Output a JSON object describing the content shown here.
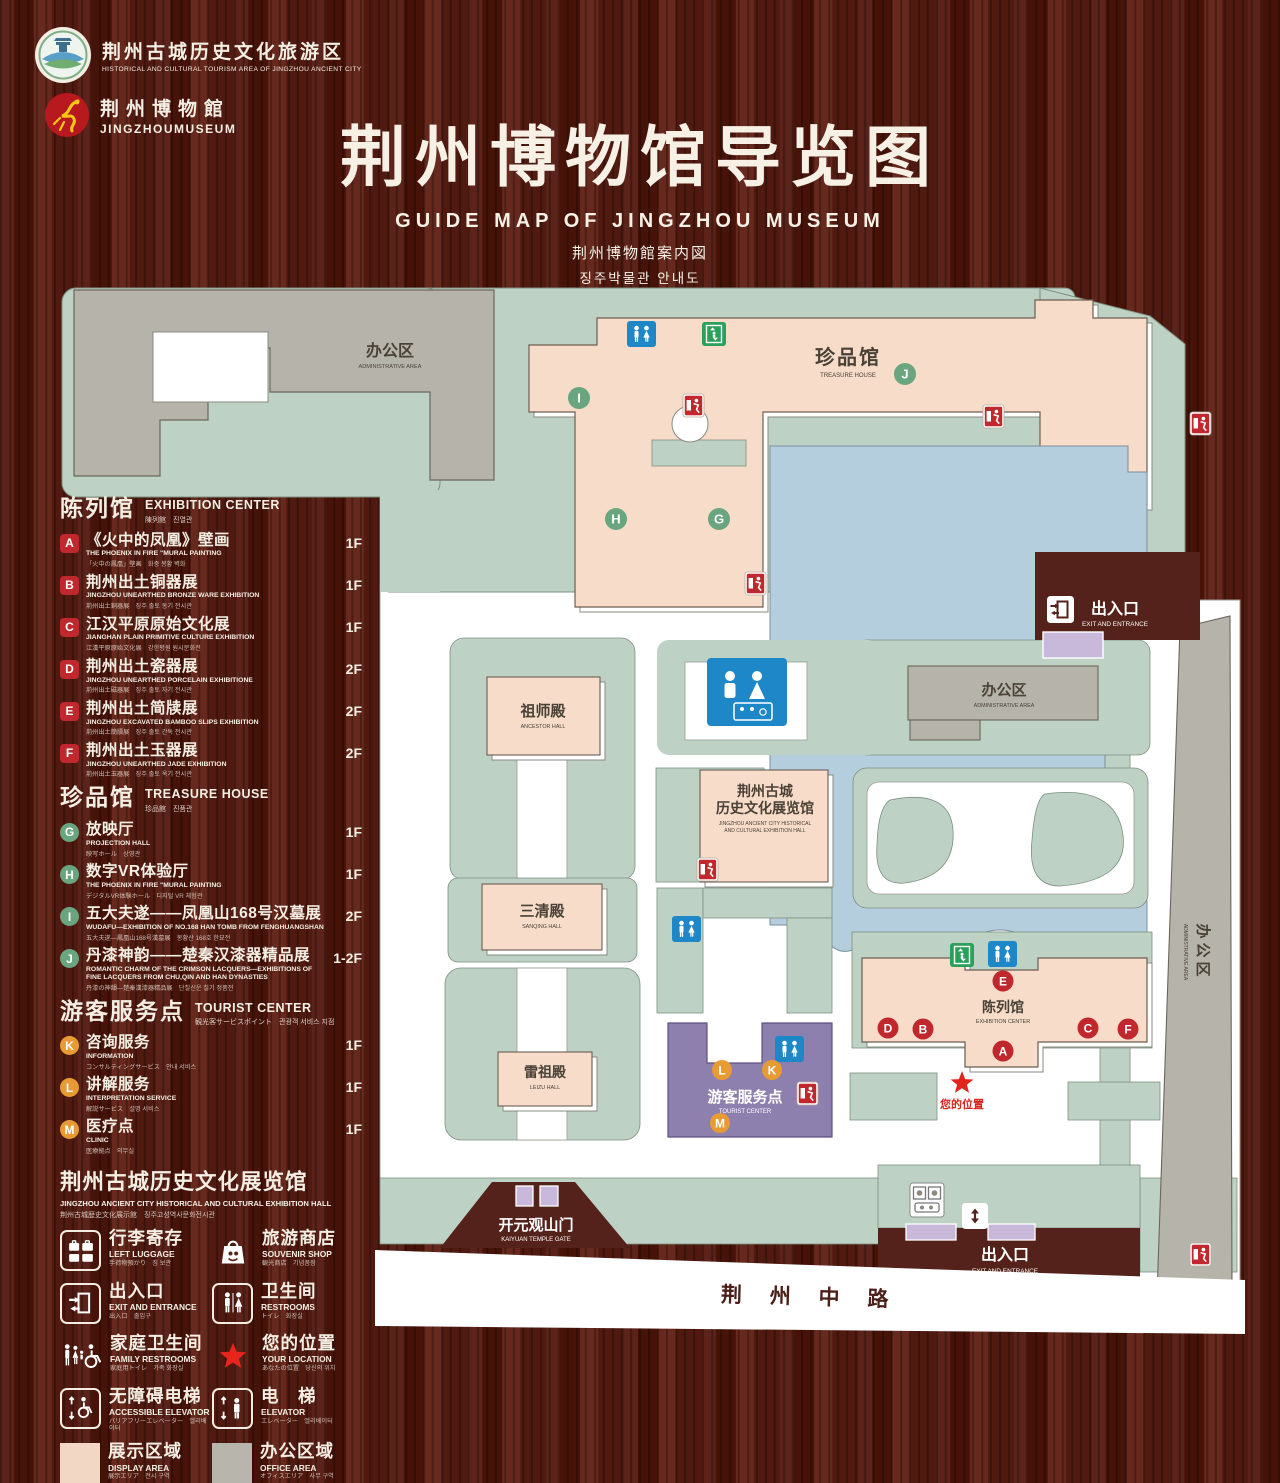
{
  "header": {
    "logo1": {
      "zh": "荆州古城历史文化旅游区",
      "en": "HISTORICAL AND CULTURAL TOURISM AREA OF JINGZHOU ANCIENT CITY"
    },
    "logo2": {
      "zh": "荆州博物館",
      "en": "JINGZHOUMUSEUM"
    },
    "title_zh": "荆州博物馆导览图",
    "title_en": "GUIDE MAP OF JINGZHOU MUSEUM",
    "title_jp": "荆州博物館案内図",
    "title_kr": "징주박물관 안내도"
  },
  "legend": {
    "sections": [
      {
        "id": "exhibition",
        "title_zh": "陈列馆",
        "title_en": "EXHIBITION CENTER",
        "title_sub": "陳列館　진열관",
        "badge_shape": "square",
        "badge_color": "#c0282d",
        "items": [
          {
            "letter": "A",
            "zh": "《火中的凤凰》壁画",
            "en": "THE PHOENIX IN FIRE \"MURAL PAINTING",
            "sub": "「火中の鳳凰」壁画　화중 봉황 벽화",
            "floor": "1F"
          },
          {
            "letter": "B",
            "zh": "荆州出土铜器展",
            "en": "JINGZHOU UNEARTHED BRONZE WARE EXHIBITION",
            "sub": "荊州出土銅器展　징주 출토 동기 전시관",
            "floor": "1F"
          },
          {
            "letter": "C",
            "zh": "江汉平原原始文化展",
            "en": "JIANGHAN PLAIN PRIMITIVE CULTURE EXHIBITION",
            "sub": "江漢平原原始文化展　강한평원 원시문화전",
            "floor": "1F"
          },
          {
            "letter": "D",
            "zh": "荆州出土瓷器展",
            "en": "JINGZHOU UNEARTHED PORCELAIN EXHIBITIONE",
            "sub": "荊州出土磁器展　징주 출토 자기 전시관",
            "floor": "2F"
          },
          {
            "letter": "E",
            "zh": "荆州出土简牍展",
            "en": "JINGZHOU EXCAVATED BAMBOO SLIPS EXHIBITION",
            "sub": "荊州出土簡牘展　징주 출토 간독 전시관",
            "floor": "2F"
          },
          {
            "letter": "F",
            "zh": "荆州出土玉器展",
            "en": "JINGZHOU UNEARTHED JADE EXHIBITION",
            "sub": "荊州出土玉器展　징주 출토 옥기 전시관",
            "floor": "2F"
          }
        ]
      },
      {
        "id": "treasure",
        "title_zh": "珍品馆",
        "title_en": "TREASURE HOUSE",
        "title_sub": "珍品館　진품관",
        "badge_shape": "circle",
        "badge_color": "#69a57e",
        "items": [
          {
            "letter": "G",
            "zh": "放映厅",
            "en": "PROJECTION HALL",
            "sub": "映写ホール　상영관",
            "floor": "1F"
          },
          {
            "letter": "H",
            "zh": "数字VR体验厅",
            "en": "THE PHOENIX IN FIRE \"MURAL PAINTING",
            "sub": "デジタルVR体験ホール　디지털 VR 체험관",
            "floor": "1F"
          },
          {
            "letter": "I",
            "zh": "五大夫遂——凤凰山168号汉墓展",
            "en": "WUDAFU—EXHIBITION OF NO.168 HAN TOMB FROM FENGHUANGSHAN",
            "sub": "五大夫遂—鳳凰山168号漢墓展　봉황산 168호 한묘전",
            "floor": "2F"
          },
          {
            "letter": "J",
            "zh": "丹漆神韵——楚秦汉漆器精品展",
            "en": "ROMANTIC CHARM OF THE CRIMSON LACQUERS—EXHIBITIONS OF FINE LACQUERS FROM CHU,QIN AND HAN DYNASTIES",
            "sub": "丹漆の神韻—楚秦漢漆器精品展　단칠신운 칠기 정품전",
            "floor": "1-2F"
          }
        ]
      },
      {
        "id": "tourist",
        "title_zh": "游客服务点",
        "title_en": "TOURIST CENTER",
        "title_sub": "観光客サービスポイント　관광객 서비스 지점",
        "badge_shape": "circle",
        "badge_color": "#e89b33",
        "items": [
          {
            "letter": "K",
            "zh": "咨询服务",
            "en": "INFORMATION",
            "sub": "コンサルティングサービス　안내 서비스",
            "floor": "1F"
          },
          {
            "letter": "L",
            "zh": "讲解服务",
            "en": "INTERPRETATION SERVICE",
            "sub": "解説サービス　설명 서비스",
            "floor": "1F"
          },
          {
            "letter": "M",
            "zh": "医疗点",
            "en": "CLINIC",
            "sub": "医療拠点　의무실",
            "floor": "1F"
          }
        ]
      }
    ],
    "hall_heading": {
      "zh": "荆州古城历史文化展览馆",
      "en": "JINGZHOU ANCIENT CITY HISTORICAL AND CULTURAL EXHIBITION HALL",
      "sub": "荆州古城歴史文化展示館　징주고성역사문화전시관"
    },
    "icons": [
      {
        "icon": "left-luggage",
        "boxed": true,
        "zh": "行李寄存",
        "en": "LEFT LUGGAGE",
        "sub": "手荷物預かり　짐 보관"
      },
      {
        "icon": "souvenir-shop",
        "boxed": false,
        "zh": "旅游商店",
        "en": "SOUVENIR SHOP",
        "sub": "観光商店　기념품점"
      },
      {
        "icon": "exit-entrance",
        "boxed": true,
        "zh": "出入口",
        "en": "EXIT AND ENTRANCE",
        "sub": "出入口　출입구"
      },
      {
        "icon": "restrooms",
        "boxed": true,
        "zh": "卫生间",
        "en": "RESTROOMS",
        "sub": "トイレ　화장실"
      },
      {
        "icon": "family-restrooms",
        "boxed": false,
        "zh": "家庭卫生间",
        "en": "FAMILY RESTROOMS",
        "sub": "家庭用トイレ　가족 화장실"
      },
      {
        "icon": "your-location",
        "boxed": false,
        "zh": "您的位置",
        "en": "YOUR LOCATION",
        "sub": "あなたの位置　당신의 위치"
      },
      {
        "icon": "accessible-elevator",
        "boxed": true,
        "zh": "无障碍电梯",
        "en": "ACCESSIBLE ELEVATOR",
        "sub": "バリアフリーエレベーター　엘리베이터"
      },
      {
        "icon": "elevator",
        "boxed": true,
        "zh": "电　梯",
        "en": "ELEVATOR",
        "sub": "エレベーター　엘리베이터"
      },
      {
        "icon": "display-area",
        "swatch": "#f2d8c4",
        "zh": "展示区域",
        "en": "DISPLAY AREA",
        "sub": "展示エリア　전시 구역"
      },
      {
        "icon": "office-area",
        "swatch": "#b8b6ac",
        "zh": "办公区域",
        "en": "OFFICE AREA",
        "sub": "オフィスエリア　사무 구역"
      }
    ]
  },
  "map": {
    "labels": {
      "admin_tl_zh": "办公区",
      "admin_tl_en": "ADMINISTRATIVE AREA",
      "treasure_zh": "珍品馆",
      "treasure_en": "TREASURE HOUSE",
      "ancestor_zh": "祖师殿",
      "ancestor_en": "ANCESTOR HALL",
      "sanqing_zh": "三清殿",
      "sanqing_en": "SANQING HALL",
      "leizu_zh": "雷祖殿",
      "leizu_en": "LEIZU HALL",
      "hist_zh1": "荆州古城",
      "hist_zh2": "历史文化展览馆",
      "hist_en1": "JINGZHOU ANCIENT CITY HISTORICAL",
      "hist_en2": "AND CULTURAL EXHIBITION HALL",
      "admin_r_zh": "办公区",
      "admin_r_en": "ADMINISTRATIVE AREA",
      "admin_strip_zh": "办公区",
      "admin_strip_en": "ADMINISTRATIVE AREA",
      "tourist_zh": "游客服务点",
      "tourist_en": "TOURIST CENTER",
      "exhibition_zh": "陈列馆",
      "exhibition_en": "EXHIBITION CENTER",
      "exit_tr_zh": "出入口",
      "exit_tr_en": "EXIT AND ENTRANCE",
      "exit_b_zh": "出入口",
      "exit_b_en": "EXIT AND ENTRANCE",
      "gate_zh": "开元观山门",
      "gate_en": "KAIYUAN TEMPLE GATE",
      "location_zh": "您的位置",
      "road_zh": "荆 州 中 路"
    },
    "badges": {
      "A": "A",
      "B": "B",
      "C": "C",
      "D": "D",
      "E": "E",
      "F": "F",
      "G": "G",
      "H": "H",
      "I": "I",
      "J": "J",
      "K": "K",
      "L": "L",
      "M": "M"
    }
  }
}
